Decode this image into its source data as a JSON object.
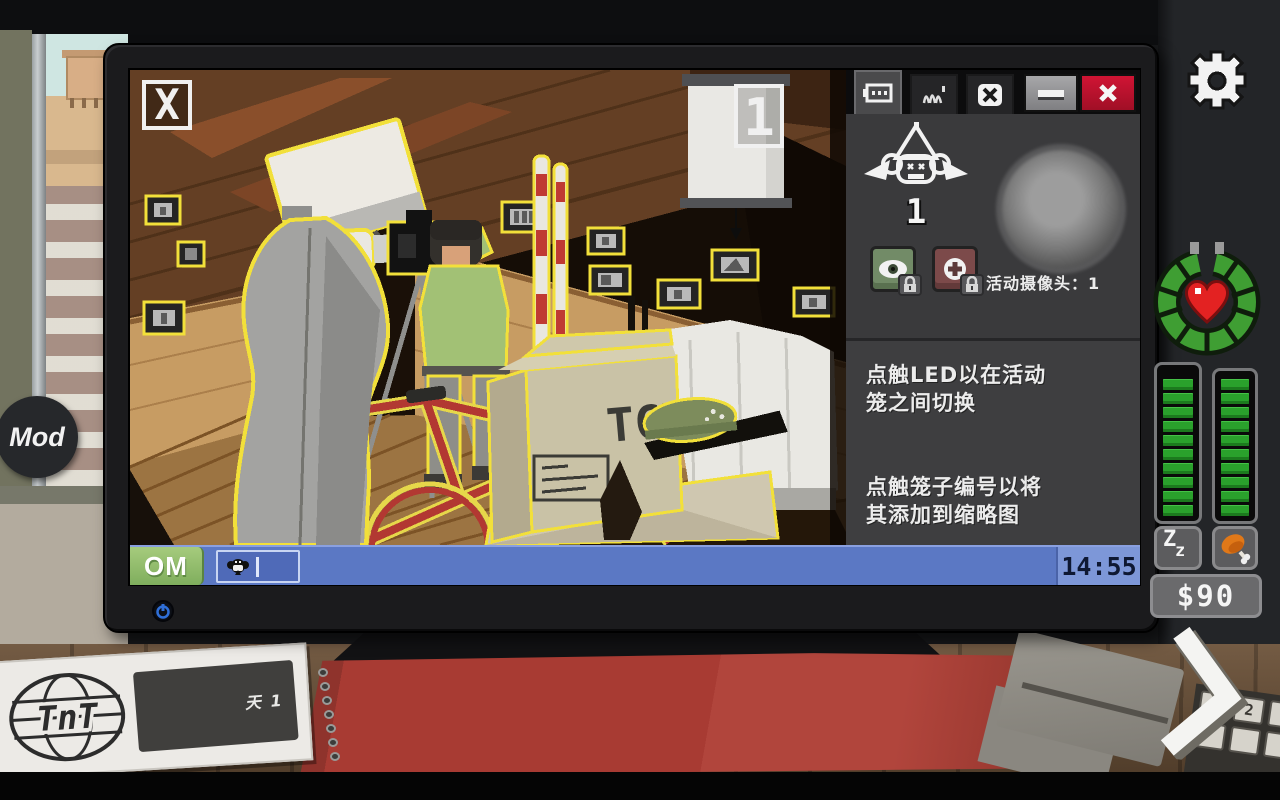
{
  "colors": {
    "highlight_outline": "#f2e03a",
    "taskbar_blue": "#5b78c4",
    "start_green": "#8cba6b",
    "close_red": "#c01330",
    "panel_gray": "#3a3a3c",
    "bar_green": "#2aa12c",
    "heart_red": "#e32222",
    "bezel_black": "#1b1b1d"
  },
  "monitor": {
    "power_icon": "power-icon",
    "feed": {
      "close_label": "X",
      "cage_number": "1",
      "box_stencil": "TCT",
      "scene_items": [
        "mannequin",
        "softbox-light",
        "telephoto-lens",
        "photographer",
        "camera-on-tripod",
        "red-bicycle",
        "cardboard-boxes",
        "green-helmet",
        "skis",
        "projector-screen",
        "white-sofa",
        "framed-photos"
      ]
    },
    "panel": {
      "tabs": [
        {
          "icon": "cage-camera-icon",
          "selected": true
        },
        {
          "icon": "claw-icon",
          "selected": false
        },
        {
          "icon": "x-icon",
          "selected": false
        }
      ],
      "minimize_icon": "minimize-icon",
      "close_icon": "close-icon",
      "monkey_badge": {
        "icon": "winged-monkey-icon",
        "count": "1"
      },
      "led_status": "off",
      "eye_button": {
        "icon": "eye-icon",
        "locked": true
      },
      "add_button": {
        "icon": "plus-icon",
        "locked": true
      },
      "active_cameras_label": "活动摄像头：",
      "active_cameras_value": "1",
      "tips": [
        "点触LED以在活动\n笼之间切换",
        "点触笼子编号以将\n其添加到缩略图"
      ]
    },
    "taskbar": {
      "start_label": "OM",
      "task_icon": "monkey-icon",
      "clock": "14:55"
    }
  },
  "hud": {
    "settings_icon": "gear-icon",
    "mod_label": "Mod",
    "life_ring": {
      "icon": "heart-icon",
      "segments": 10
    },
    "sleep_bar": {
      "segments": 10,
      "chars": [
        "Z",
        "z"
      ]
    },
    "hunger_bar": {
      "segments": 10,
      "icon": "drumstick-icon"
    },
    "money": "$90",
    "next_icon": "chevron-right-icon",
    "day_card": {
      "logo": "TnT",
      "day": "天 1"
    },
    "keyboard_key": "2"
  }
}
